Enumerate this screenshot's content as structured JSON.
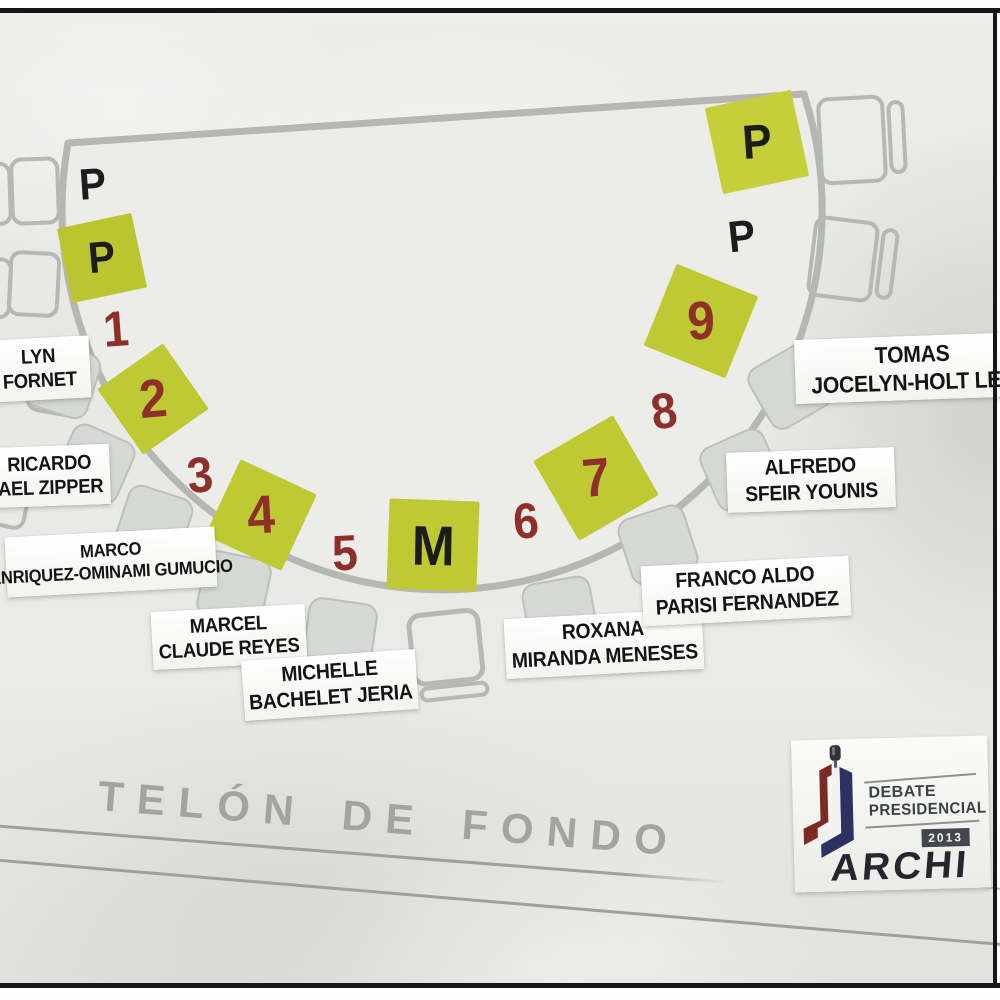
{
  "stage": {
    "backdrop_label": "TELÓN DE FONDO",
    "shape": "semicircular stage plan on wrinkled paper photo",
    "seats": [
      {
        "label": "P",
        "style": "plain-text"
      },
      {
        "label": "P",
        "style": "green-square"
      },
      {
        "label": "1",
        "style": "plain-text"
      },
      {
        "label": "2",
        "style": "green-square"
      },
      {
        "label": "3",
        "style": "plain-text"
      },
      {
        "label": "4",
        "style": "green-square"
      },
      {
        "label": "5",
        "style": "plain-text"
      },
      {
        "label": "M",
        "style": "green-square"
      },
      {
        "label": "6",
        "style": "plain-text"
      },
      {
        "label": "7",
        "style": "green-square"
      },
      {
        "label": "8",
        "style": "plain-text"
      },
      {
        "label": "9",
        "style": "green-square"
      },
      {
        "label": "P",
        "style": "plain-text"
      },
      {
        "label": "P",
        "style": "green-square"
      }
    ]
  },
  "candidates": [
    {
      "seat": "1",
      "line1": "LYN",
      "line2": "FORNET"
    },
    {
      "seat": "2",
      "line1": "RICARDO",
      "line2": "AEL ZIPPER"
    },
    {
      "seat": "3",
      "line1": "MARCO",
      "line2": "ENRIQUEZ-OMINAMI GUMUCIO"
    },
    {
      "seat": "4",
      "line1": "MARCEL",
      "line2": "CLAUDE REYES"
    },
    {
      "seat": "5",
      "line1": "MICHELLE",
      "line2": "BACHELET JERIA"
    },
    {
      "seat": "6",
      "line1": "ROXANA",
      "line2": "MIRANDA MENESES"
    },
    {
      "seat": "7",
      "line1": "FRANCO ALDO",
      "line2": "PARISI FERNANDEZ"
    },
    {
      "seat": "8",
      "line1": "ALFREDO",
      "line2": "SFEIR YOUNIS"
    },
    {
      "seat": "9",
      "line1": "TOMAS",
      "line2": "JOCELYN-HOLT LET"
    }
  ],
  "logo": {
    "line1": "DEBATE",
    "line2": "PRESIDENCIAL",
    "year": "2013",
    "org": "ARCHI"
  },
  "colors": {
    "paper": "#e8e8e6",
    "stage_outline": "#b4b7b4",
    "seat_green": "#bfc933",
    "seat_number": "#8e2f29",
    "seat_letter": "#1c1c1c",
    "chair_fill": "#d5d8d5",
    "backdrop_text": "#a2a49f",
    "logo_maroon": "#7b2b23",
    "logo_navy": "#2b3160",
    "frame": "#171717"
  }
}
